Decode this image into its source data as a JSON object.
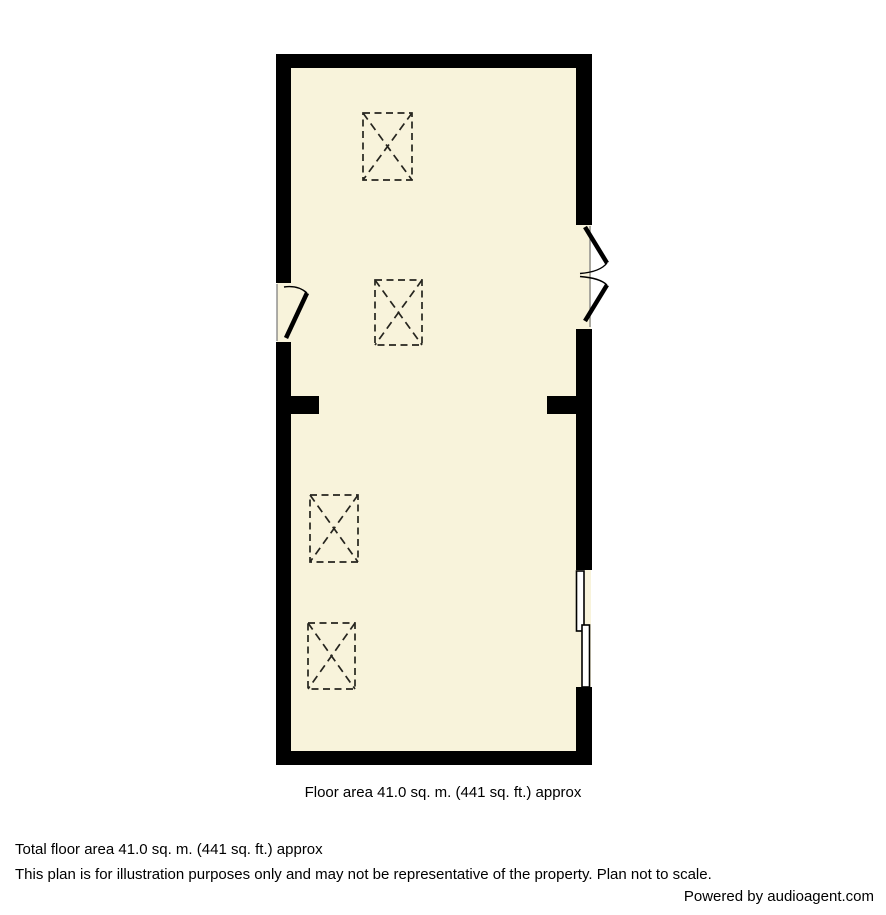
{
  "plan": {
    "floor_area_caption": "Floor area 41.0 sq. m. (441 sq. ft.) approx",
    "symbols": [
      {
        "name": "skylight-symbol",
        "count": 4
      },
      {
        "name": "single-door-swing",
        "count": 1
      },
      {
        "name": "double-door-swing",
        "count": 1
      },
      {
        "name": "sliding-door-symbol",
        "count": 1
      }
    ]
  },
  "footer": {
    "total_floor_area": "Total floor area 41.0 sq. m. (441 sq. ft.) approx",
    "disclaimer": "This plan is for illustration purposes only and may not be representative of the property. Plan not to scale.",
    "powered_by": "Powered by audioagent.com"
  },
  "colors": {
    "wall": "#000000",
    "floor": "#F8F3DB",
    "background": "#FFFFFF",
    "symbol-line": "#26251F"
  }
}
